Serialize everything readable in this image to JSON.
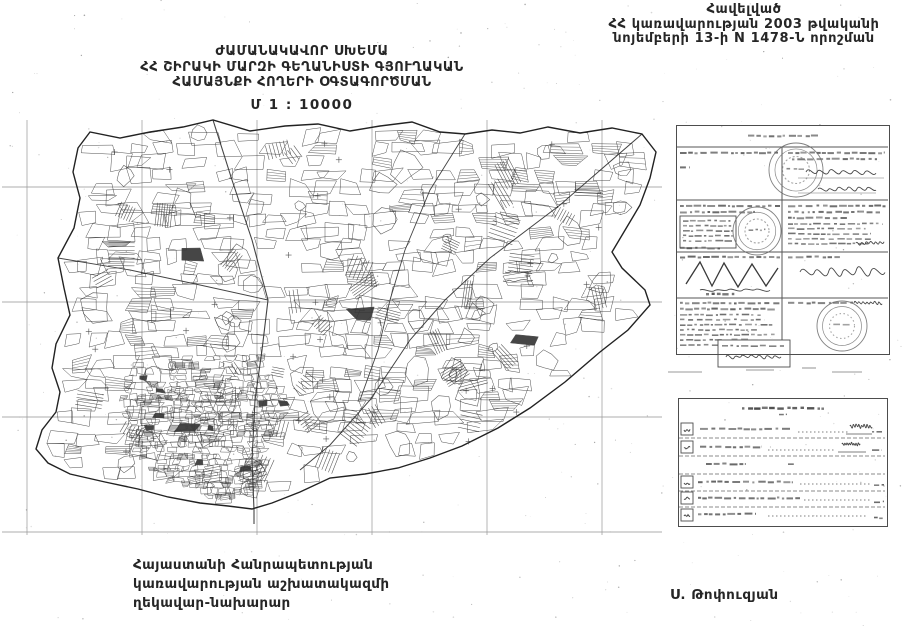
{
  "document": {
    "appendix": {
      "line1": "Հավելված",
      "line2": "ՀՀ կառավարության 2003 թվականի",
      "line3": "նոյեմբերի 13-ի N 1478-Ն որոշման"
    },
    "title": {
      "line1": "ԺԱՄԱՆԱԿԱՎՈՐ ՍԽԵՄԱ",
      "line2": "ՀՀ ՇԻՐԱԿԻ ՄԱՐԶԻ ԳԵՂԱՆԻՍՏԻ ԳՅՈՒՂԱԿԱՆ",
      "line3": "ՀԱՄԱՅՆՔԻ ՀՈՂԵՐԻ ՕԳՏԱԳՈՐԾՄԱՆ",
      "scale": "Մ 1 : 10000"
    },
    "footer": {
      "line1": "Հայաստանի Հանրապետության",
      "line2": "կառավարության աշխատակազմի",
      "line3": "ղեկավար-նախարար",
      "signature": "Ս. Թոփուզյան"
    }
  },
  "colors": {
    "ink": "#262626",
    "map_line": "#3d3d3d",
    "grid_line": "#9a9a9a",
    "stamp": "#6a6a6a",
    "smudge": "#4a4a4a",
    "paper": "#ffffff"
  }
}
